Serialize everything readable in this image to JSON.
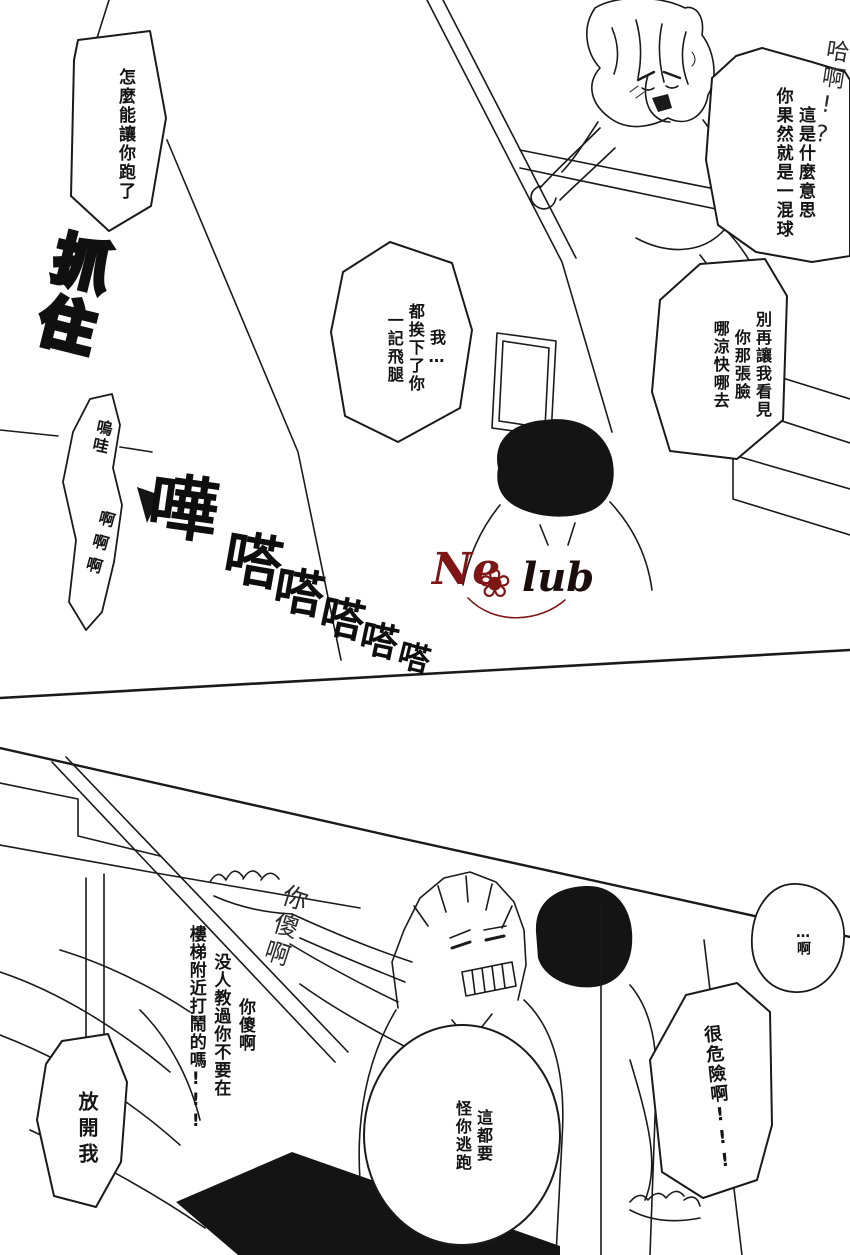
{
  "page": {
    "bg": "#ffffff",
    "ink": "#1a1a1a"
  },
  "watermark": {
    "name_part1": "Ne",
    "name_part2": "lub",
    "rose_glyph": "❀",
    "red": "#7e1616",
    "black": "#1c0d0d"
  },
  "panel_top": {
    "bubbles": {
      "escape": {
        "lines": [
          "怎麼能讓你跑了"
        ]
      },
      "meaning": {
        "lines": [
          "這是什麼意思",
          "你果然就是一混球"
        ]
      },
      "kick": {
        "lines": [
          "我…",
          "都挨下了你",
          "一記飛腿"
        ]
      },
      "face": {
        "lines": [
          "別再讓我看見",
          "你那張臉",
          "哪涼快哪去"
        ]
      },
      "scream": {
        "top": "嗚哇",
        "bottom": "啊啊啊"
      }
    },
    "handwritten": {
      "haa": "哈啊!?"
    },
    "sfx": {
      "grab": "抓住",
      "clatter": [
        "嘩",
        "嗒",
        "嗒",
        "嗒",
        "嗒",
        "嗒"
      ]
    }
  },
  "panel_bottom": {
    "bubbles": {
      "letgo": {
        "lines": [
          "放開我"
        ]
      },
      "blame": {
        "lines": [
          "這都要",
          "怪你逃跑"
        ]
      },
      "ah": {
        "lines": [
          "…啊"
        ]
      },
      "danger": {
        "lines": [
          "很危險啊!!!"
        ]
      }
    },
    "text": {
      "scold": {
        "lines": [
          "你傻啊",
          "没人教過你不要在",
          "樓梯附近打鬧的嗎!!!"
        ]
      }
    },
    "handwritten": {
      "fool": "你傻啊"
    }
  }
}
